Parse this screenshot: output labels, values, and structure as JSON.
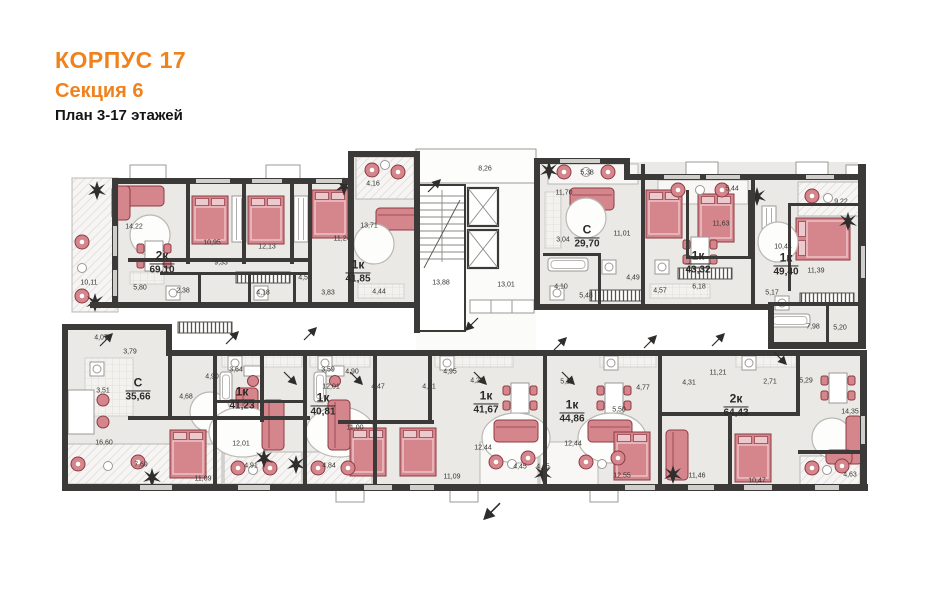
{
  "header": {
    "building": "КОРПУС 17",
    "section": "Секция 6",
    "plan": "План 3-17 этажей"
  },
  "colors": {
    "accent": "#f0821e",
    "wall": "#3b3a38",
    "floor": "#eae9e6",
    "furniture": "#d5868d",
    "furniture_dark": "#8d3a42",
    "text": "#2b2a28"
  },
  "apartments": [
    {
      "type": "2к",
      "area": "69,10",
      "x": 162,
      "y": 263
    },
    {
      "type": "1к",
      "area": "41,85",
      "x": 358,
      "y": 272
    },
    {
      "type": "С",
      "area": "29,70",
      "x": 587,
      "y": 237
    },
    {
      "type": "1к",
      "area": "43,32",
      "x": 698,
      "y": 263
    },
    {
      "type": "1к",
      "area": "49,40",
      "x": 786,
      "y": 265
    },
    {
      "type": "С",
      "area": "35,66",
      "x": 138,
      "y": 390
    },
    {
      "type": "1к",
      "area": "41,23",
      "x": 242,
      "y": 399
    },
    {
      "type": "1к",
      "area": "40,81",
      "x": 323,
      "y": 405
    },
    {
      "type": "1к",
      "area": "41,67",
      "x": 486,
      "y": 403
    },
    {
      "type": "1к",
      "area": "44,86",
      "x": 572,
      "y": 412
    },
    {
      "type": "2к",
      "area": "64,43",
      "x": 736,
      "y": 406
    }
  ],
  "rooms": [
    {
      "v": "14,22",
      "x": 134,
      "y": 227
    },
    {
      "v": "10,95",
      "x": 212,
      "y": 243
    },
    {
      "v": "12,13",
      "x": 267,
      "y": 247
    },
    {
      "v": "11,24",
      "x": 342,
      "y": 239
    },
    {
      "v": "10,11",
      "x": 89,
      "y": 283
    },
    {
      "v": "5,80",
      "x": 140,
      "y": 288
    },
    {
      "v": "2,38",
      "x": 183,
      "y": 291
    },
    {
      "v": "9,33",
      "x": 221,
      "y": 263
    },
    {
      "v": "4,18",
      "x": 263,
      "y": 293
    },
    {
      "v": "4,54",
      "x": 305,
      "y": 278
    },
    {
      "v": "3,83",
      "x": 328,
      "y": 293
    },
    {
      "v": "4,16",
      "x": 373,
      "y": 184
    },
    {
      "v": "13,71",
      "x": 369,
      "y": 226
    },
    {
      "v": "4,44",
      "x": 379,
      "y": 292
    },
    {
      "v": "8,26",
      "x": 485,
      "y": 169
    },
    {
      "v": "13,88",
      "x": 441,
      "y": 283
    },
    {
      "v": "13,01",
      "x": 506,
      "y": 285
    },
    {
      "v": "5,38",
      "x": 587,
      "y": 173
    },
    {
      "v": "11,70",
      "x": 564,
      "y": 193
    },
    {
      "v": "3,04",
      "x": 563,
      "y": 240
    },
    {
      "v": "11,01",
      "x": 622,
      "y": 234
    },
    {
      "v": "4,10",
      "x": 561,
      "y": 287
    },
    {
      "v": "5,48",
      "x": 586,
      "y": 296
    },
    {
      "v": "4,49",
      "x": 633,
      "y": 278
    },
    {
      "v": "4,57",
      "x": 660,
      "y": 291
    },
    {
      "v": "6,18",
      "x": 699,
      "y": 287
    },
    {
      "v": "5,44",
      "x": 732,
      "y": 189
    },
    {
      "v": "11,63",
      "x": 721,
      "y": 224
    },
    {
      "v": "9,22",
      "x": 841,
      "y": 202
    },
    {
      "v": "10,44",
      "x": 783,
      "y": 247
    },
    {
      "v": "11,39",
      "x": 816,
      "y": 271
    },
    {
      "v": "5,17",
      "x": 772,
      "y": 293
    },
    {
      "v": "7,98",
      "x": 813,
      "y": 327
    },
    {
      "v": "5,20",
      "x": 840,
      "y": 328
    },
    {
      "v": "4,07",
      "x": 101,
      "y": 338
    },
    {
      "v": "3,79",
      "x": 130,
      "y": 352
    },
    {
      "v": "3,51",
      "x": 103,
      "y": 391
    },
    {
      "v": "4,90",
      "x": 212,
      "y": 377
    },
    {
      "v": "4,68",
      "x": 186,
      "y": 397
    },
    {
      "v": "16,60",
      "x": 104,
      "y": 443
    },
    {
      "v": "7,69",
      "x": 141,
      "y": 465
    },
    {
      "v": "11,09",
      "x": 203,
      "y": 479
    },
    {
      "v": "3,64",
      "x": 236,
      "y": 370
    },
    {
      "v": "12,01",
      "x": 241,
      "y": 444
    },
    {
      "v": "4,91",
      "x": 251,
      "y": 466
    },
    {
      "v": "3,59",
      "x": 328,
      "y": 370
    },
    {
      "v": "12,01",
      "x": 331,
      "y": 387
    },
    {
      "v": "11,00",
      "x": 355,
      "y": 428
    },
    {
      "v": "4,84",
      "x": 329,
      "y": 466
    },
    {
      "v": "4,90",
      "x": 352,
      "y": 372
    },
    {
      "v": "4,47",
      "x": 378,
      "y": 387
    },
    {
      "v": "4,51",
      "x": 429,
      "y": 387
    },
    {
      "v": "4,95",
      "x": 450,
      "y": 372
    },
    {
      "v": "11,09",
      "x": 452,
      "y": 477
    },
    {
      "v": "4,23",
      "x": 477,
      "y": 381
    },
    {
      "v": "12,44",
      "x": 483,
      "y": 448
    },
    {
      "v": "4,45",
      "x": 520,
      "y": 467
    },
    {
      "v": "4,45",
      "x": 543,
      "y": 467
    },
    {
      "v": "5,15",
      "x": 567,
      "y": 382
    },
    {
      "v": "12,44",
      "x": 573,
      "y": 444
    },
    {
      "v": "5,50",
      "x": 619,
      "y": 410
    },
    {
      "v": "12,55",
      "x": 622,
      "y": 476
    },
    {
      "v": "11,21",
      "x": 718,
      "y": 373
    },
    {
      "v": "4,31",
      "x": 689,
      "y": 383
    },
    {
      "v": "4,77",
      "x": 643,
      "y": 388
    },
    {
      "v": "2,71",
      "x": 770,
      "y": 382
    },
    {
      "v": "5,29",
      "x": 806,
      "y": 381
    },
    {
      "v": "14,35",
      "x": 850,
      "y": 412
    },
    {
      "v": "11,46",
      "x": 697,
      "y": 476
    },
    {
      "v": "10,47",
      "x": 757,
      "y": 481
    },
    {
      "v": "4,63",
      "x": 850,
      "y": 475
    }
  ]
}
